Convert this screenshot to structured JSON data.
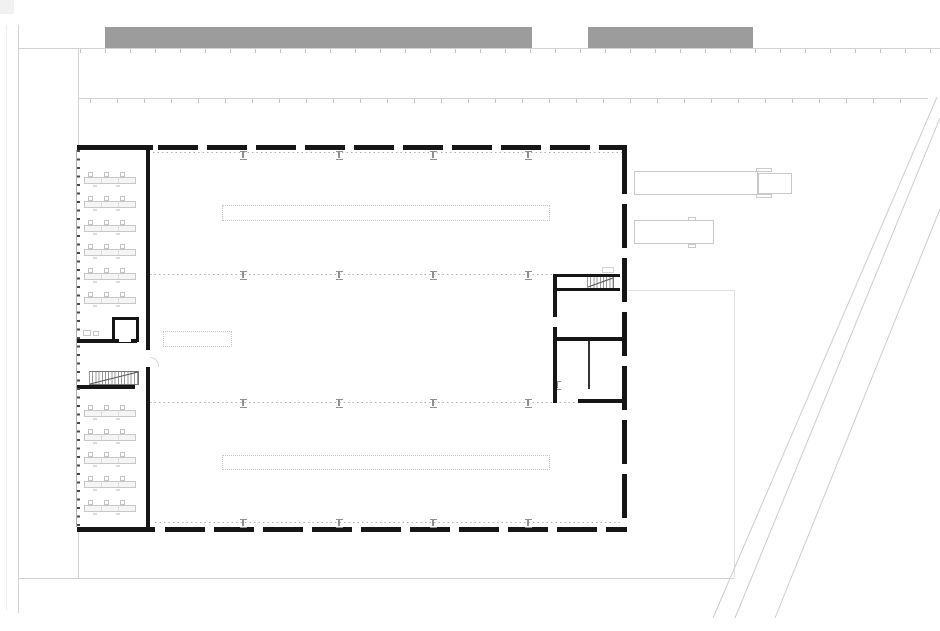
{
  "canvas": {
    "w": 940,
    "h": 631,
    "bg": "#ffffff"
  },
  "palette": {
    "wall": "#161616",
    "wall_medium": "#333333",
    "line_light": "#d2d2d2",
    "line_lighter": "#e2e2e2",
    "line_faint": "#ededed",
    "dotted": "#b0b0b0",
    "road": "#cdcdcd",
    "bar": "#9c9c9c",
    "corner": "#f2f1f1",
    "furniture": "#c8c8c8",
    "furniture_fill": "#f5f5f5",
    "vehicle": "#c9c9c9",
    "column": "#8f8f8f",
    "hatch": "#9b9b9b",
    "stair_edge": "#777777",
    "glazing_tick": "#4a4a4a",
    "glazing_edge": "#b0b0b0",
    "strip": "#c6c6c6",
    "door": "#d8d8d8",
    "tickline": "#c2c2c2"
  },
  "site": {
    "rects": [
      {
        "name": "canopy-bar-left",
        "x": 105,
        "y": 27,
        "w": 427,
        "h": 22,
        "fill": "bar"
      },
      {
        "name": "canopy-bar-right",
        "x": 588,
        "y": 27,
        "w": 165,
        "h": 22,
        "fill": "bar"
      },
      {
        "name": "corner-marker",
        "x": 0,
        "y": 0,
        "w": 14,
        "h": 14,
        "fill": "corner"
      }
    ],
    "vlines": [
      {
        "name": "site-boundary-far-left",
        "x": 6,
        "y1": 25,
        "y2": 610,
        "color": "line_faint"
      },
      {
        "name": "site-boundary-left",
        "x": 18,
        "y1": 25,
        "y2": 613,
        "color": "line_light"
      },
      {
        "name": "facade-extension-upper",
        "x": 78,
        "y1": 48,
        "y2": 145,
        "color": "line_light"
      },
      {
        "name": "facade-extension-lower",
        "x": 78,
        "y1": 532,
        "y2": 578,
        "color": "line_light"
      },
      {
        "name": "yard-boundary-right",
        "x": 734,
        "y1": 290,
        "y2": 578,
        "color": "line_lighter"
      }
    ],
    "hlines": [
      {
        "name": "fence-line-upper",
        "x1": 18,
        "x2": 940,
        "y": 48,
        "color": "line_light"
      },
      {
        "name": "fence-line-lower",
        "x1": 79,
        "x2": 928,
        "y": 98,
        "color": "line_light"
      },
      {
        "name": "yard-boundary-bottom",
        "x1": 18,
        "x2": 734,
        "y": 578,
        "color": "line_light"
      },
      {
        "name": "yard-boundary-top",
        "x1": 628,
        "x2": 734,
        "y": 290,
        "color": "line_lighter"
      }
    ],
    "tick_strips": [
      {
        "name": "fence-posts-upper",
        "x": 80,
        "y": 49,
        "w": 856,
        "h": 4,
        "gap": 25
      },
      {
        "name": "fence-posts-lower",
        "x": 90,
        "y": 99,
        "w": 836,
        "h": 4,
        "gap": 27
      }
    ],
    "diagonals": [
      {
        "name": "road-edge-1",
        "x1": 937,
        "y1": 97,
        "x2": 713,
        "y2": 618
      },
      {
        "name": "road-edge-2",
        "x1": 940,
        "y1": 118,
        "x2": 735,
        "y2": 618
      },
      {
        "name": "road-edge-3",
        "x1": 940,
        "y1": 209,
        "x2": 775,
        "y2": 618
      }
    ]
  },
  "building": {
    "walls_solid": [
      {
        "name": "north-wall-west-segment",
        "x": 77,
        "y": 145,
        "w": 76,
        "h": 5
      },
      {
        "name": "south-wall-west-segment",
        "x": 77,
        "y": 527,
        "w": 78,
        "h": 5
      },
      {
        "name": "office-partition-wall-upper",
        "x": 145.5,
        "y": 148,
        "w": 4.5,
        "h": 202
      },
      {
        "name": "office-partition-wall-lower",
        "x": 145.5,
        "y": 367,
        "w": 4.5,
        "h": 160
      },
      {
        "name": "office-mid-wall",
        "x": 77,
        "y": 339,
        "w": 60,
        "h": 3.5
      },
      {
        "name": "office-stair-wall",
        "x": 77,
        "y": 385,
        "w": 58,
        "h": 3.5
      }
    ],
    "walls_dashed": [
      {
        "name": "north-wall-dashed",
        "x": 158,
        "y": 145,
        "w": 469,
        "h": 5,
        "dir": "h"
      },
      {
        "name": "south-wall-dashed",
        "x": 165,
        "y": 527,
        "w": 462,
        "h": 5,
        "dir": "h"
      },
      {
        "name": "east-wall-dashed",
        "x": 622,
        "y": 150,
        "w": 5,
        "h": 382,
        "dir": "v"
      }
    ],
    "glazed_wall": {
      "name": "west-glazed-facade",
      "x": 76,
      "y": 150,
      "w": 4,
      "h": 377
    },
    "grid_dotted_lines": [
      {
        "name": "grid-line-north",
        "x": 153,
        "y": 152,
        "w": 469
      },
      {
        "name": "grid-line-mid-upper",
        "x": 150,
        "y": 274,
        "w": 403
      },
      {
        "name": "grid-line-mid-lower",
        "x": 150,
        "y": 402,
        "w": 428
      },
      {
        "name": "grid-line-south",
        "x": 155,
        "y": 522,
        "w": 467
      }
    ],
    "columns": {
      "w": 7,
      "h": 9,
      "positions": [
        [
          243,
          155
        ],
        [
          339,
          155
        ],
        [
          433,
          155
        ],
        [
          528,
          155
        ],
        [
          243,
          275
        ],
        [
          339,
          275
        ],
        [
          433,
          275
        ],
        [
          528,
          275
        ],
        [
          243,
          403
        ],
        [
          339,
          403
        ],
        [
          433,
          403
        ],
        [
          528,
          403
        ],
        [
          557,
          385
        ],
        [
          243,
          523
        ],
        [
          339,
          523
        ],
        [
          433,
          523
        ],
        [
          528,
          523
        ]
      ]
    },
    "strips": [
      {
        "name": "crane-runway-north",
        "x": 222,
        "y": 205,
        "w": 328,
        "h": 16
      },
      {
        "name": "crane-runway-south",
        "x": 222,
        "y": 455,
        "w": 328,
        "h": 15
      },
      {
        "name": "workbench-outline",
        "x": 163,
        "y": 331,
        "w": 69,
        "h": 16
      }
    ]
  },
  "left_wing": {
    "desk": {
      "x": 84,
      "w": 52,
      "h": 15,
      "chair_offsets": [
        4,
        20,
        36
      ],
      "mark_offsets": [
        9,
        32
      ]
    },
    "desk_rows_upper": [
      172,
      196,
      220,
      244,
      268,
      292
    ],
    "desk_rows_lower": [
      405,
      429,
      452,
      476,
      500
    ],
    "small_room": {
      "name": "service-room",
      "x": 112,
      "y": 317,
      "w": 27,
      "h": 25,
      "wall": 3,
      "door_x": 119,
      "door_w": 12
    },
    "cabinets": [
      {
        "name": "cabinet",
        "x": 83,
        "y": 330,
        "w": 8,
        "h": 6
      },
      {
        "name": "cabinet",
        "x": 93,
        "y": 331,
        "w": 6,
        "h": 5
      }
    ],
    "stair": {
      "name": "office-stair",
      "x": 89,
      "y": 371,
      "w": 50,
      "h": 14
    },
    "door_arc": {
      "name": "door-swing",
      "x": 150,
      "y": 357,
      "w": 9,
      "h": 10
    }
  },
  "right_rooms": {
    "walls": [
      {
        "name": "stairroom-wall-top",
        "x": 553,
        "y": 273.5,
        "w": 67,
        "h": 3.5
      },
      {
        "name": "stairroom-wall-below-stair",
        "x": 553,
        "y": 288,
        "w": 67,
        "h": 3
      },
      {
        "name": "stairroom-wall-west-upper",
        "x": 553,
        "y": 273.5,
        "w": 3.5,
        "h": 43.5
      },
      {
        "name": "stairroom-wall-west-lower",
        "x": 553,
        "y": 327,
        "w": 3.5,
        "h": 76
      },
      {
        "name": "room-divider-wall",
        "x": 553,
        "y": 337,
        "w": 74,
        "h": 3.5
      },
      {
        "name": "room-thin-partition",
        "x": 588,
        "y": 340.5,
        "w": 1.5,
        "h": 48,
        "fill": "wall_medium"
      },
      {
        "name": "room-south-wall",
        "x": 578,
        "y": 399,
        "w": 49,
        "h": 3.5
      }
    ],
    "stair": {
      "name": "hall-stair",
      "x": 587,
      "y": 277,
      "w": 27,
      "h": 11
    },
    "stair_landing": {
      "name": "stair-landing",
      "x": 602,
      "y": 267,
      "w": 12,
      "h": 6
    }
  },
  "stair_diagonals": [
    {
      "name": "office-stair-direction-line",
      "x1": 90,
      "y1": 384,
      "x2": 138,
      "y2": 372
    },
    {
      "name": "hall-stair-direction-line",
      "x1": 588,
      "y1": 287,
      "x2": 613,
      "y2": 278
    }
  ],
  "vehicles": {
    "truck": {
      "name": "semi-truck-outline",
      "trailer": {
        "x": 634,
        "y": 171,
        "w": 124,
        "h": 24
      },
      "cab": {
        "x": 758,
        "y": 172.5,
        "w": 34,
        "h": 21
      },
      "mirrors": [
        {
          "x": 756,
          "y": 167.5,
          "w": 16,
          "h": 4
        },
        {
          "x": 756,
          "y": 193.5,
          "w": 16,
          "h": 4
        }
      ]
    },
    "van": {
      "name": "van-outline",
      "body": {
        "x": 634,
        "y": 220,
        "w": 80,
        "h": 24
      },
      "mirrors": [
        {
          "x": 688,
          "y": 216.5,
          "w": 8,
          "h": 4
        },
        {
          "x": 688,
          "y": 243.5,
          "w": 8,
          "h": 4
        }
      ]
    }
  }
}
